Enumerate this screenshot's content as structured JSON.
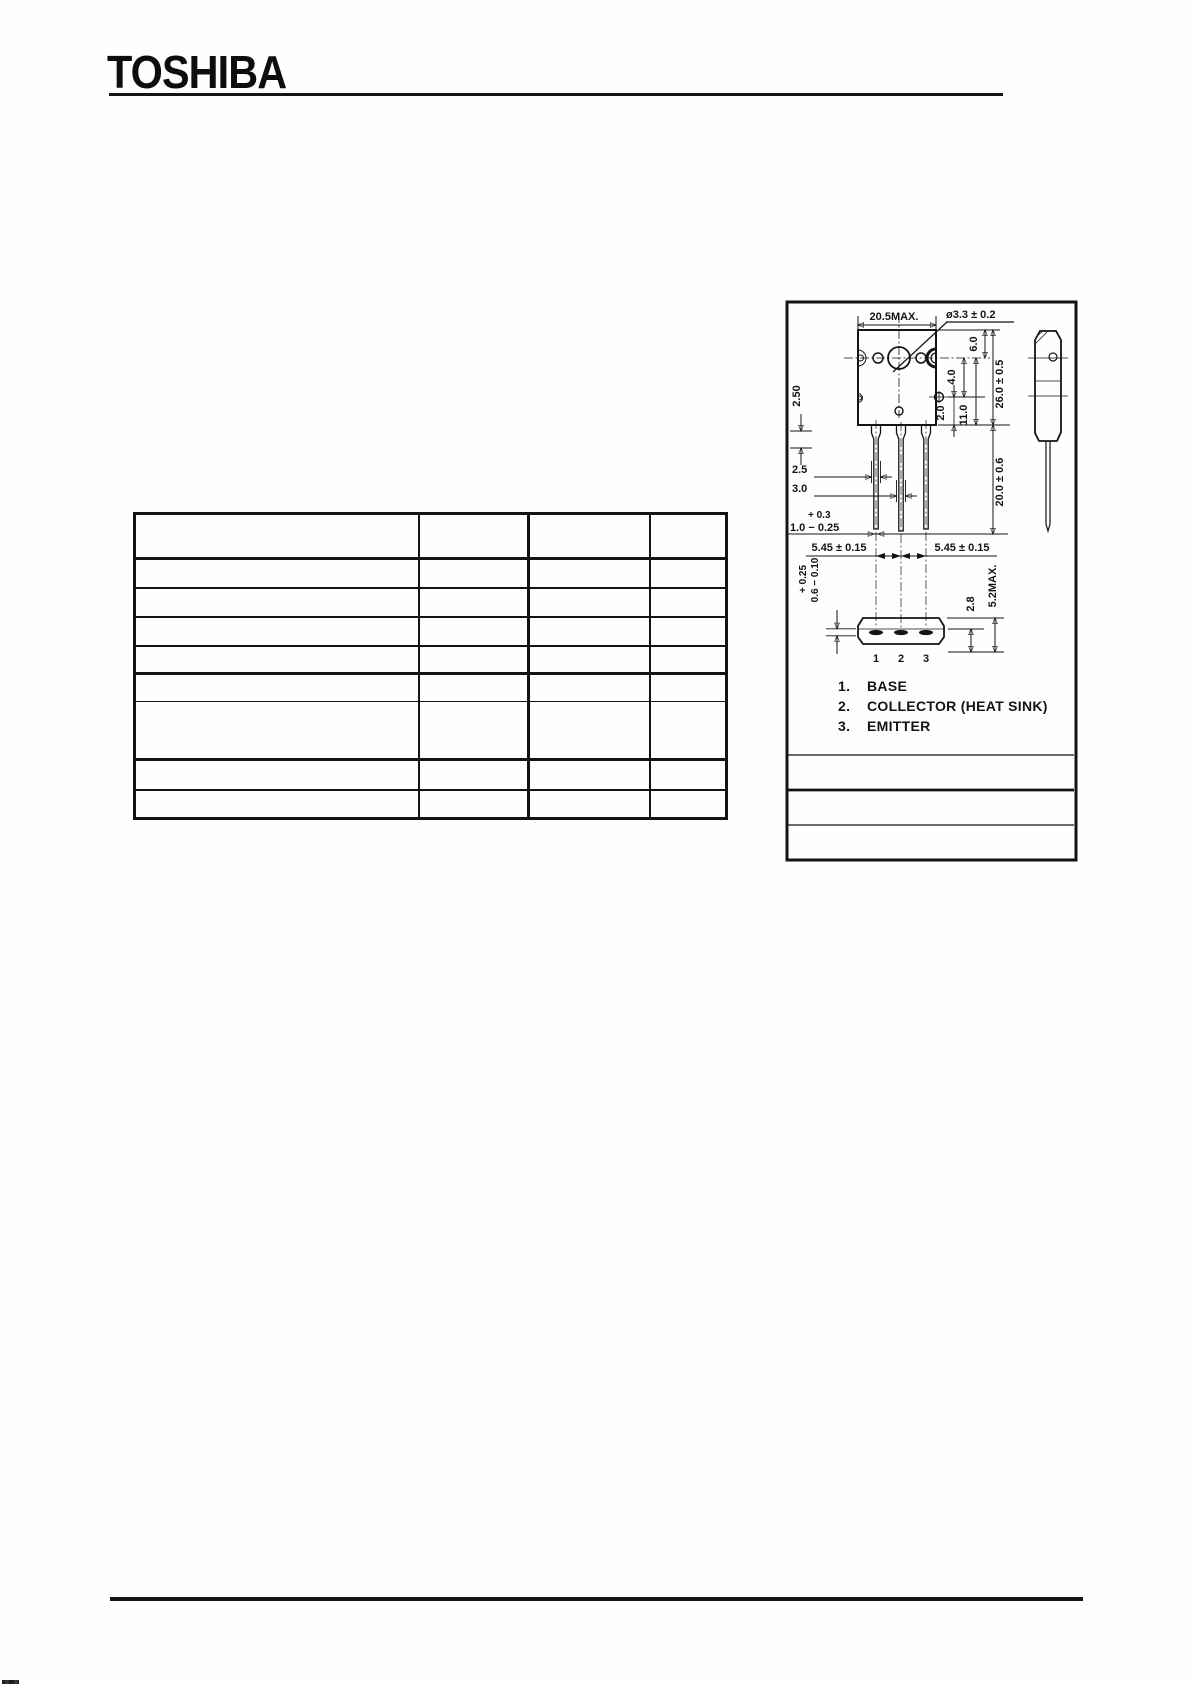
{
  "page": {
    "brand": "TOSHIBA"
  },
  "ratings_table": {
    "headers": [
      "",
      "",
      "",
      ""
    ]
  },
  "drawing": {
    "dims": {
      "body_width": "20.5MAX.",
      "hole_dia": "ø3.3 ± 0.2",
      "hole_to_top": "6.0",
      "body_height": "26.0 ± 0.5",
      "hole_offset_a": "4.0",
      "hole_offset_b": "2.0",
      "tab_height": "11.0",
      "lead_length": "20.0 ± 0.6",
      "shoulder_len": "2.50",
      "lead_width_outer": "2.5",
      "lead_width_center": "3.0",
      "lead_thk_plus": "+ 0.3",
      "lead_thk": "1.0 − 0.25",
      "lead_pitch_left": "5.45 ± 0.15",
      "lead_pitch_right": "5.45 ± 0.15",
      "pin_thk_plus": "+ 0.25",
      "pin_thk": "0.6 − 0.10",
      "standoff": "2.8",
      "base_height": "5.2MAX."
    },
    "pin_numbers": [
      "1",
      "2",
      "3"
    ],
    "pin_list": [
      {
        "num": "1.",
        "label": "BASE"
      },
      {
        "num": "2.",
        "label": "COLLECTOR (HEAT SINK)"
      },
      {
        "num": "3.",
        "label": "EMITTER"
      }
    ]
  }
}
